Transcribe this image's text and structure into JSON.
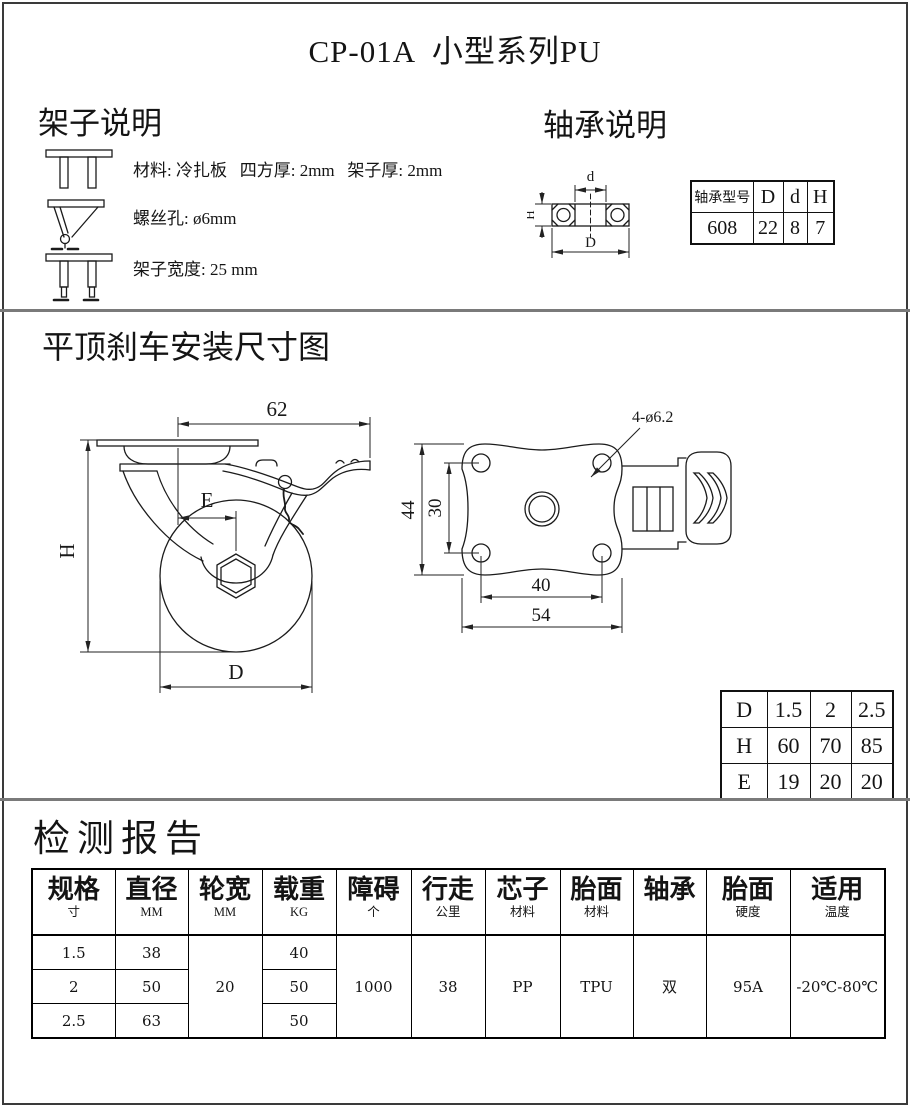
{
  "title": "CP-01A  小型系列PU",
  "frame_section": {
    "heading": "架子说明",
    "items": [
      {
        "icon": "fork-front-view-icon",
        "text": "材料: 冷扎板   四方厚: 2mm   架子厚: 2mm"
      },
      {
        "icon": "swivel-side-view-icon",
        "text": "螺丝孔: ø6mm"
      },
      {
        "icon": "fork-width-view-icon",
        "text": "架子宽度: 25 mm"
      }
    ]
  },
  "bearing_section": {
    "heading": "轴承说明",
    "diagram": {
      "bore_label": "d",
      "outer_label": "D",
      "height_label": "H"
    },
    "table": {
      "headers": [
        "轴承型号",
        "D",
        "d",
        "H"
      ],
      "row": [
        "608",
        "22",
        "8",
        "7"
      ]
    }
  },
  "install_section": {
    "heading": "平顶刹车安装尺寸图",
    "side_view": {
      "total_length": "62",
      "offset_label": "E",
      "height_label": "H",
      "wheel_diameter_label": "D"
    },
    "top_view": {
      "plate_height": "44",
      "hole_spacing_v": "30",
      "hole_spacing_h": "40",
      "plate_width": "54",
      "holes_label": "4-ø6.2"
    },
    "dhe_table": {
      "rows": [
        [
          "D",
          "1.5",
          "2",
          "2.5"
        ],
        [
          "H",
          "60",
          "70",
          "85"
        ],
        [
          "E",
          "19",
          "20",
          "20"
        ]
      ]
    }
  },
  "report_section": {
    "heading": "检测报告",
    "table": {
      "columns": [
        {
          "main": "规格",
          "sub": "寸"
        },
        {
          "main": "直径",
          "sub": "MM"
        },
        {
          "main": "轮宽",
          "sub": "MM"
        },
        {
          "main": "载重",
          "sub": "KG"
        },
        {
          "main": "障碍",
          "sub": "个"
        },
        {
          "main": "行走",
          "sub": "公里"
        },
        {
          "main": "芯子",
          "sub": "材料"
        },
        {
          "main": "胎面",
          "sub": "材料"
        },
        {
          "main": "轴承",
          "sub": ""
        },
        {
          "main": "胎面",
          "sub": "硬度"
        },
        {
          "main": "适用",
          "sub": "温度"
        }
      ],
      "spec_rows": [
        {
          "size": "1.5",
          "diameter": "38",
          "load": "40"
        },
        {
          "size": "2",
          "diameter": "50",
          "load": "50"
        },
        {
          "size": "2.5",
          "diameter": "63",
          "load": "50"
        }
      ],
      "merged": {
        "wheel_width": "20",
        "obstacle": "1000",
        "travel": "38",
        "core_material": "PP",
        "tread_material": "TPU",
        "bearing": "双",
        "tread_hardness": "95A",
        "temperature": "-20℃-80℃"
      }
    }
  }
}
